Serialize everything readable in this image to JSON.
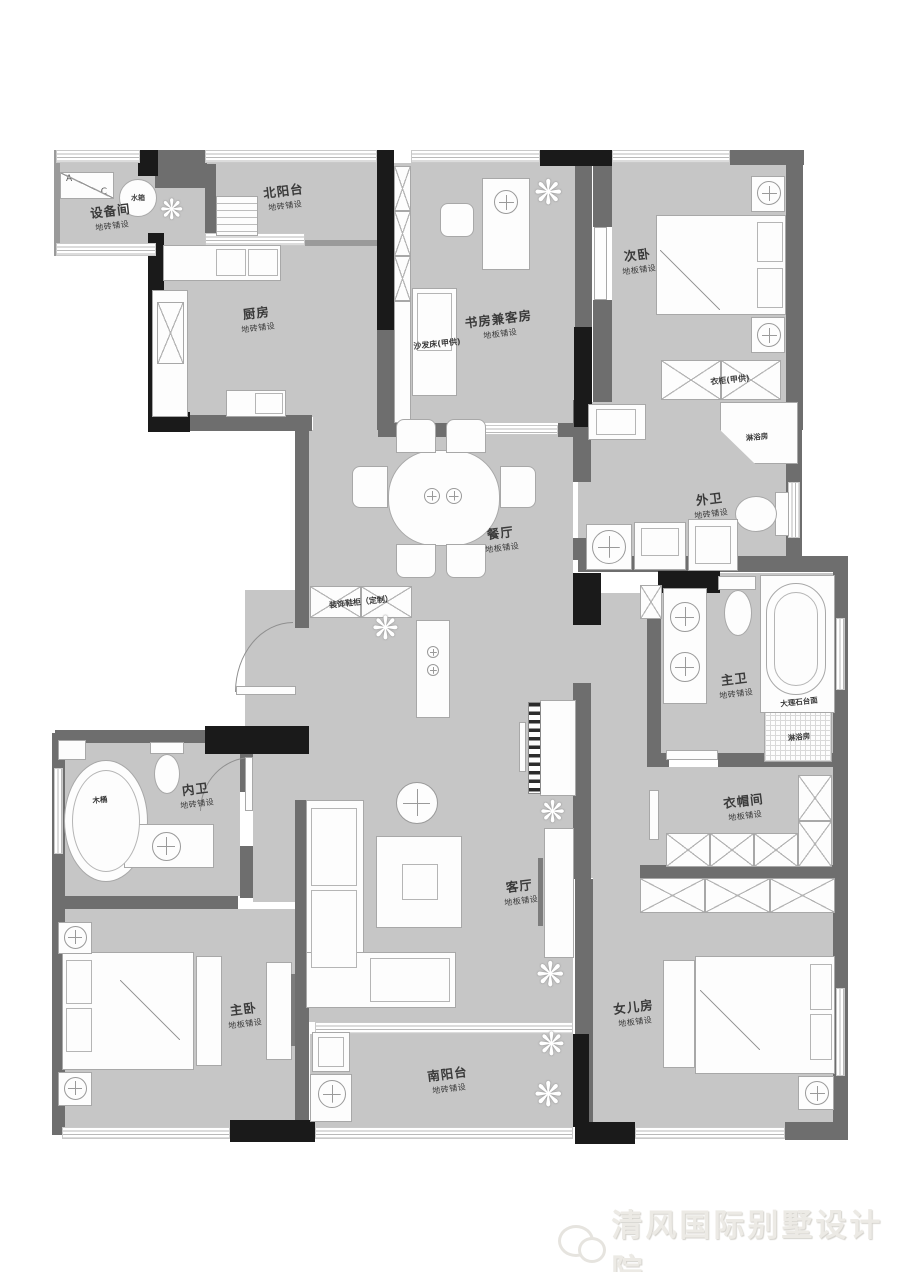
{
  "watermark": {
    "text": "清风国际别墅设计院"
  },
  "icons": {
    "plant": "❋"
  },
  "rooms": {
    "equipment_room": {
      "name": "设备间",
      "floor": "地砖铺设"
    },
    "north_balcony": {
      "name": "北阳台",
      "floor": "地砖铺设"
    },
    "kitchen": {
      "name": "厨房",
      "floor": "地砖铺设"
    },
    "study_guest": {
      "name": "书房兼客房",
      "floor": "地板铺设"
    },
    "second_bedroom": {
      "name": "次卧",
      "floor": "地板铺设"
    },
    "guest_bathroom": {
      "name": "外卫",
      "floor": "地砖铺设"
    },
    "dining_room": {
      "name": "餐厅",
      "floor": "地板铺设"
    },
    "master_bathroom": {
      "name": "主卫",
      "floor": "地砖铺设"
    },
    "inner_bathroom": {
      "name": "内卫",
      "floor": "地砖铺设"
    },
    "cloakroom": {
      "name": "衣帽间",
      "floor": "地板铺设"
    },
    "living_room": {
      "name": "客厅",
      "floor": "地板铺设"
    },
    "master_bedroom": {
      "name": "主卧",
      "floor": "地板铺设"
    },
    "daughter_room": {
      "name": "女儿房",
      "floor": "地板铺设"
    },
    "south_balcony": {
      "name": "南阳台",
      "floor": "地砖铺设"
    }
  },
  "fixtures": {
    "ac_a": "A",
    "ac_c": "C",
    "water_tank": "水箱",
    "sofa_bed": "沙发床(甲供)",
    "wardrobe": "衣柜(甲供)",
    "shoe_cabinet": "装饰鞋柜（定制）",
    "guest_shower": "淋浴房",
    "master_shower": "淋浴房",
    "marble_counter": "大理石台面",
    "wooden_tub": "木桶"
  },
  "colors": {
    "floor": "#c6c6c6",
    "wall": "#6e6e6e",
    "wall_black": "#1a1a1a"
  }
}
